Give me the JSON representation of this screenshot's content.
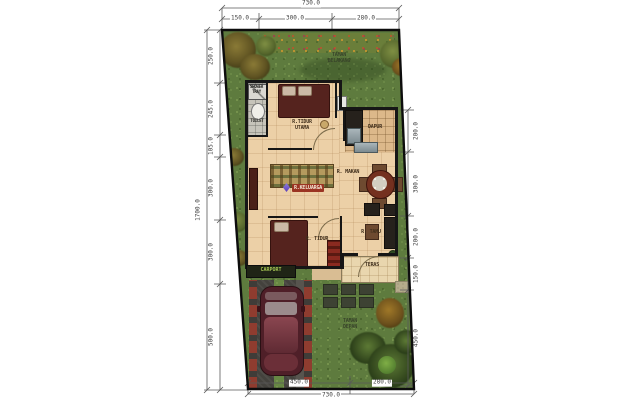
{
  "labels": {
    "taman_belakang": "TAMAN\nBELAKANG",
    "shower": "SHOWER\nTRAY",
    "toilet": "TOILET",
    "tidur_utama": "R.TIDUR\nUTAMA",
    "dapur": "DAPUR",
    "makan": "R. MAKAN",
    "keluarga": "R.KELUARGA",
    "tidur": "R. TIDUR",
    "tamu": "R. TAMU",
    "teras": "TERAS",
    "carport": "CARPORT",
    "taman_depan": "TAMAN\nDEPAN"
  },
  "dims": {
    "top_total": "730.0",
    "top": [
      "150.0",
      "300.0",
      "280.0"
    ],
    "left_total": "1700.0",
    "left": [
      "250.0",
      "245.0",
      "105.0",
      "300.0",
      "300.0",
      "500.0"
    ],
    "right": [
      "200.0",
      "300.0",
      "200.0",
      "150.0",
      "450.0"
    ],
    "bottom": [
      "450.0",
      "280.0"
    ],
    "bottom_total": "730.0"
  },
  "colors": {
    "grass_green": "#5e7b3e",
    "floor_tan": "#ecd0a7",
    "wall_black": "#161616",
    "bed_maroon": "#55231e",
    "car_maroon": "#4f1f28",
    "carport_asphalt": "#44423d",
    "paver_red": "#8f3c2f",
    "keluarga_chip": "#9b3423",
    "carport_text": "#a6c654",
    "dim_line": "#5a5a5a"
  }
}
